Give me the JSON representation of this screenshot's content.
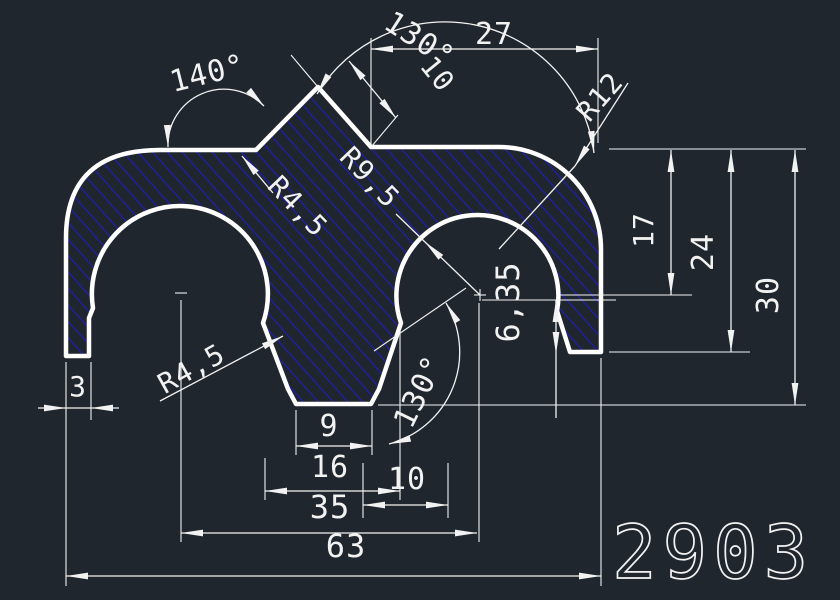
{
  "drawing": {
    "part_number": "2903",
    "colors": {
      "background": "#20262d",
      "outline": "#ffffff",
      "hatch": "#1e1eb0",
      "dimension": "#f2f2f2"
    },
    "dimension_values": {
      "angles": [
        "140°",
        "130°",
        "130°"
      ],
      "lengths": [
        "27",
        "10",
        "17",
        "24",
        "30",
        "6,35",
        "3",
        "9",
        "16",
        "10",
        "35",
        "63"
      ],
      "radii": [
        "R4,5",
        "R9,5",
        "R12",
        "R4,5"
      ]
    },
    "labels": [
      {
        "text": "140°",
        "x": 210,
        "y": 83,
        "rot": -14,
        "size": 30
      },
      {
        "text": "130°",
        "x": 414,
        "y": 48,
        "rot": 33,
        "size": 30
      },
      {
        "text": "27",
        "x": 494,
        "y": 44,
        "rot": 0,
        "size": 30
      },
      {
        "text": "10",
        "x": 430,
        "y": 80,
        "rot": 51,
        "size": 28
      },
      {
        "text": "R12",
        "x": 607,
        "y": 103,
        "rot": -49,
        "size": 28
      },
      {
        "text": "R9,5",
        "x": 363,
        "y": 184,
        "rot": 46,
        "size": 28
      },
      {
        "text": "R4,5",
        "x": 291,
        "y": 213,
        "rot": 46,
        "size": 28
      },
      {
        "text": "17",
        "x": 653,
        "y": 230,
        "rot": -90,
        "size": 28
      },
      {
        "text": "24",
        "x": 713,
        "y": 252,
        "rot": -90,
        "size": 30
      },
      {
        "text": "30",
        "x": 778,
        "y": 295,
        "rot": -90,
        "size": 30
      },
      {
        "text": "6,35",
        "x": 519,
        "y": 302,
        "rot": -90,
        "size": 32
      },
      {
        "text": "3",
        "x": 78,
        "y": 396,
        "rot": 0,
        "size": 28
      },
      {
        "text": "R4,5",
        "x": 196,
        "y": 377,
        "rot": -29,
        "size": 28
      },
      {
        "text": "130°",
        "x": 428,
        "y": 396,
        "rot": -64,
        "size": 30
      },
      {
        "text": "9",
        "x": 329,
        "y": 436,
        "rot": 0,
        "size": 30
      },
      {
        "text": "16",
        "x": 330,
        "y": 477,
        "rot": 0,
        "size": 30
      },
      {
        "text": "10",
        "x": 407,
        "y": 489,
        "rot": 0,
        "size": 30
      },
      {
        "text": "35",
        "x": 330,
        "y": 518,
        "rot": 0,
        "size": 32
      },
      {
        "text": "63",
        "x": 346,
        "y": 557,
        "rot": 0,
        "size": 32
      }
    ]
  }
}
